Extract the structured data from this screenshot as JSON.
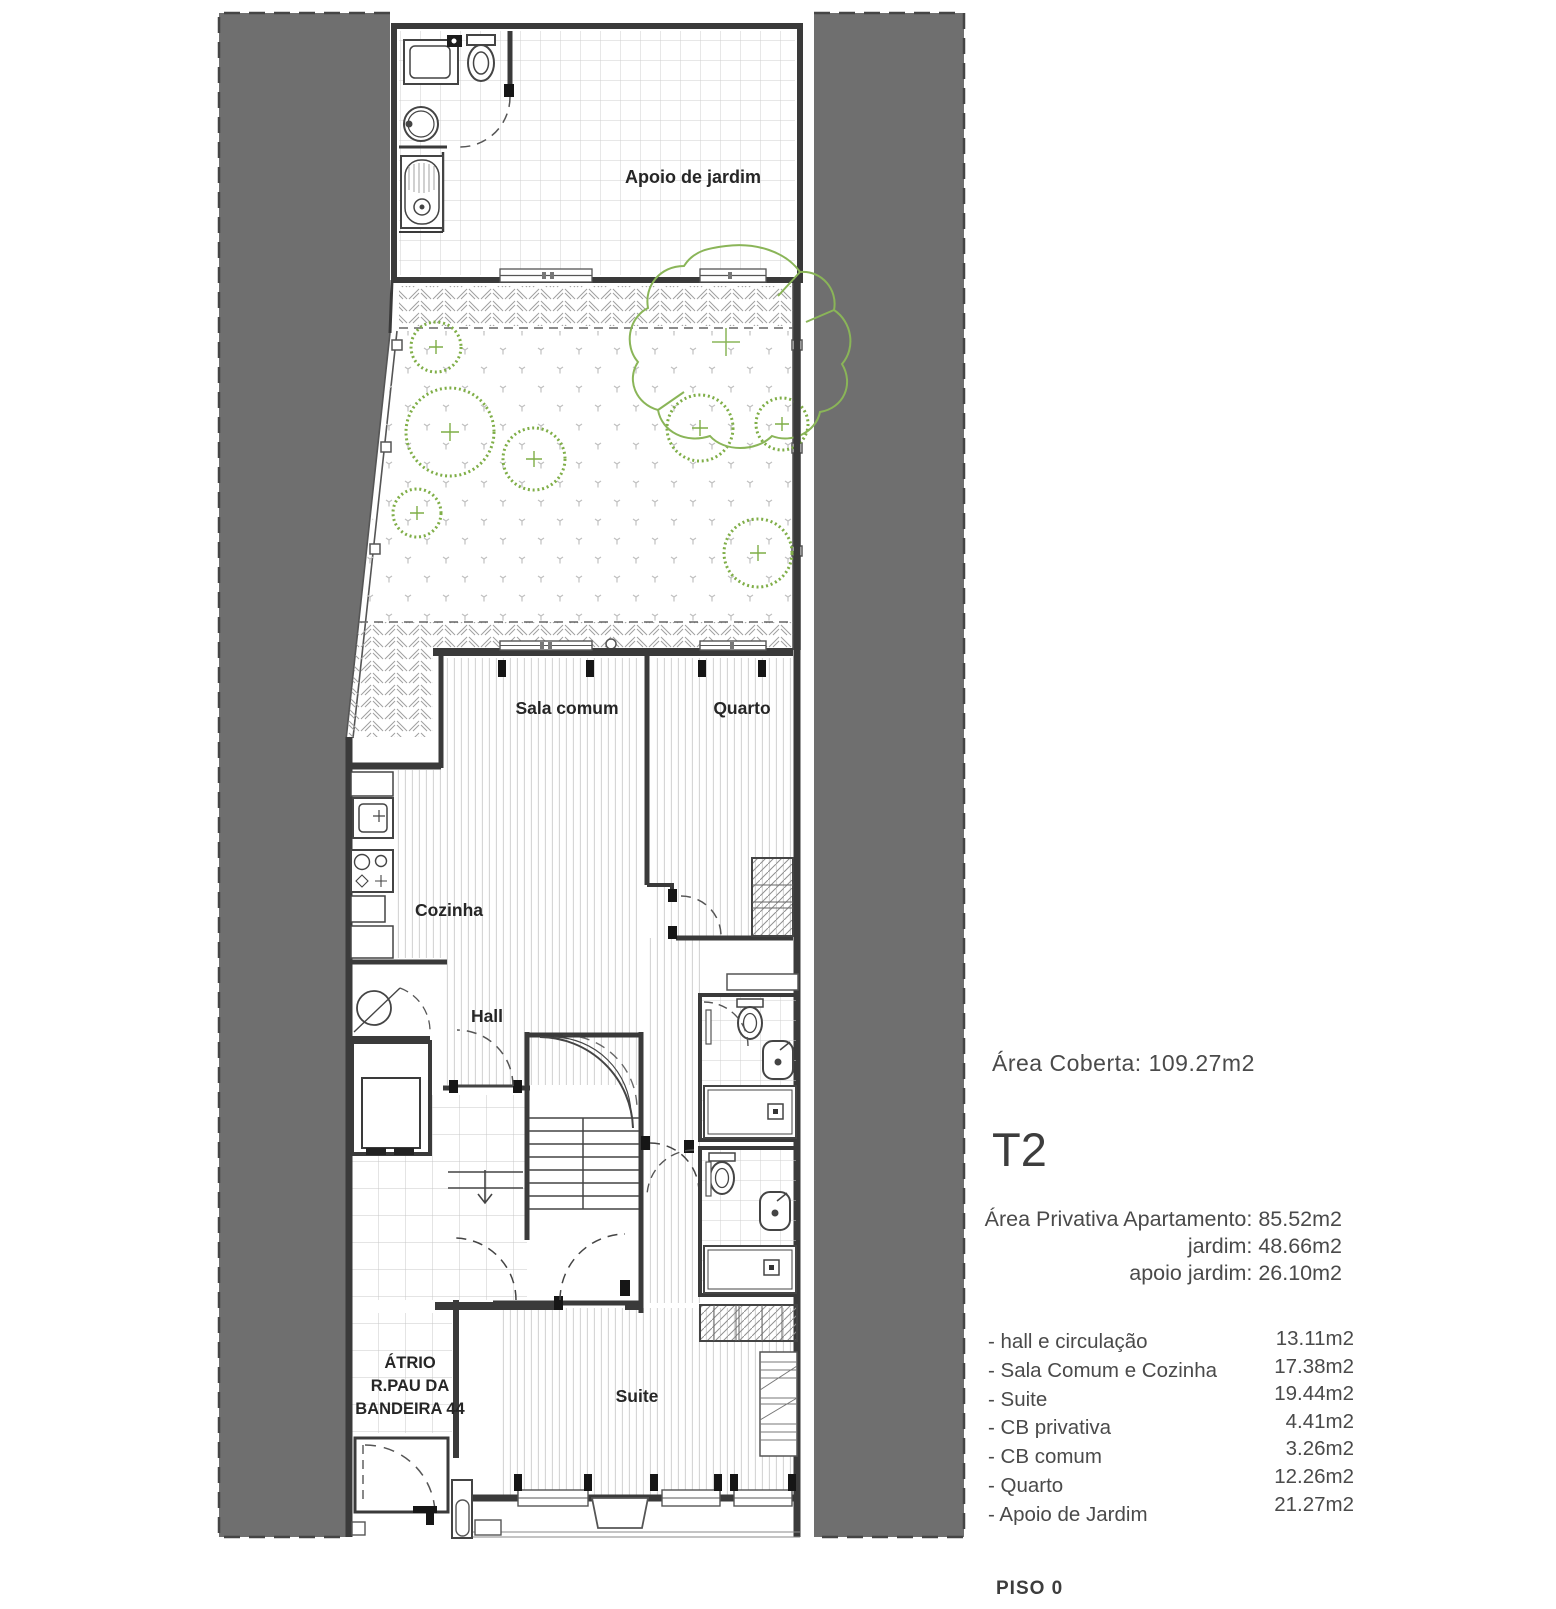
{
  "colors": {
    "neighbor_band_gray": "#6f6f6f",
    "wall": "#3a3a3a",
    "bush_green": "#7fae47",
    "tree_green": "#8ab558",
    "pattern_gray": "#c4c4c4",
    "text_gray": "#4a4a4a"
  },
  "plan": {
    "labels": {
      "apoio": "Apoio de jardim",
      "sala": "Sala comum",
      "quarto": "Quarto",
      "cozinha": "Cozinha",
      "hall": "Hall",
      "suite": "Suite",
      "atrio_line1": "ÁTRIO",
      "atrio_line2": "R.PAU DA",
      "atrio_line3": "BANDEIRA 44"
    }
  },
  "info": {
    "area_coberta": "Área Coberta: 109.27m2",
    "unit_type": "T2",
    "private_area_lines": {
      "apartment": "Área Privativa Apartamento: 85.52m2",
      "garden": "jardim: 48.66m2",
      "garden_support": "apoio jardim:  26.10m2"
    },
    "rooms": [
      {
        "label": "- hall e circulação",
        "value": "13.11m2"
      },
      {
        "label": "- Sala Comum e Cozinha",
        "value": "17.38m2"
      },
      {
        "label": "- Suite",
        "value": "19.44m2"
      },
      {
        "label": "- CB privativa",
        "value": "4.41m2"
      },
      {
        "label": "- CB comum",
        "value": "3.26m2"
      },
      {
        "label": "- Quarto",
        "value": "12.26m2"
      },
      {
        "label": "- Apoio de Jardim",
        "value": "21.27m2"
      }
    ],
    "floor_label": "PISO 0"
  }
}
